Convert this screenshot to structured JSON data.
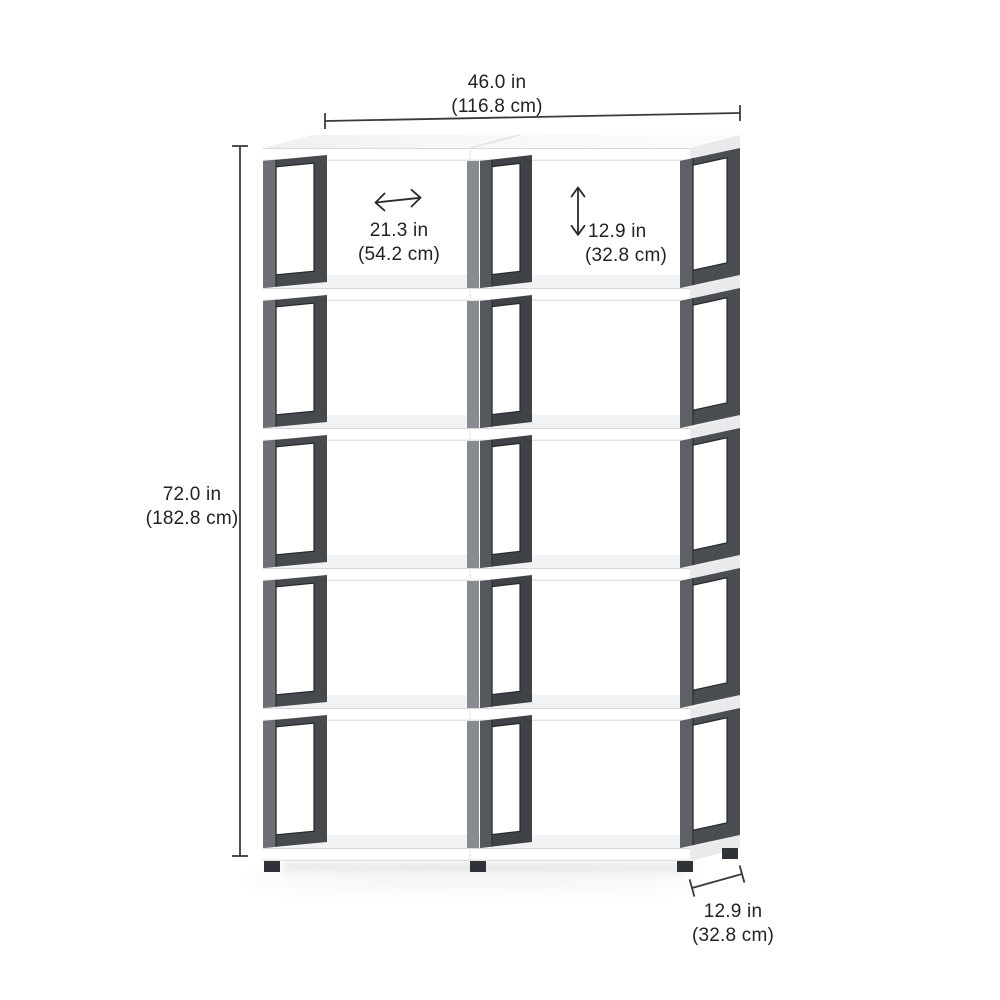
{
  "canvas": {
    "background": "#ffffff"
  },
  "product": {
    "type": "cube storage bookshelf diagram",
    "rows": 5,
    "columns": 2,
    "compartments": 10
  },
  "colors": {
    "frame": "#46494e",
    "frame_dark": "#3f4247",
    "frame_right": "#4a4d52",
    "frame_post_left": "#6c7075",
    "frame_post_mid": "#54585d",
    "frame_post_right": "#5d6165",
    "frame_mid_seam_post": "#888c91",
    "frame_edge": "#26282b",
    "board_front": "#ffffff",
    "board_top": "#f1f2f3",
    "board_side": "#e9eaeb",
    "board_edge": "#e1e2e3",
    "seam": "#ececec",
    "foot": "#2f3236",
    "dimension_line": "#3a3a3a",
    "text": "#222222"
  },
  "dimensions": {
    "overall_width": {
      "inches": "46.0 in",
      "centimeters": "(116.8 cm)"
    },
    "overall_height": {
      "inches": "72.0 in",
      "centimeters": "(182.8 cm)"
    },
    "compartment_width": {
      "inches": "21.3 in",
      "centimeters": "(54.2 cm)"
    },
    "compartment_height": {
      "inches": "12.9 in",
      "centimeters": "(32.8 cm)"
    },
    "depth": {
      "inches": "12.9 in",
      "centimeters": "(32.8 cm)"
    }
  }
}
